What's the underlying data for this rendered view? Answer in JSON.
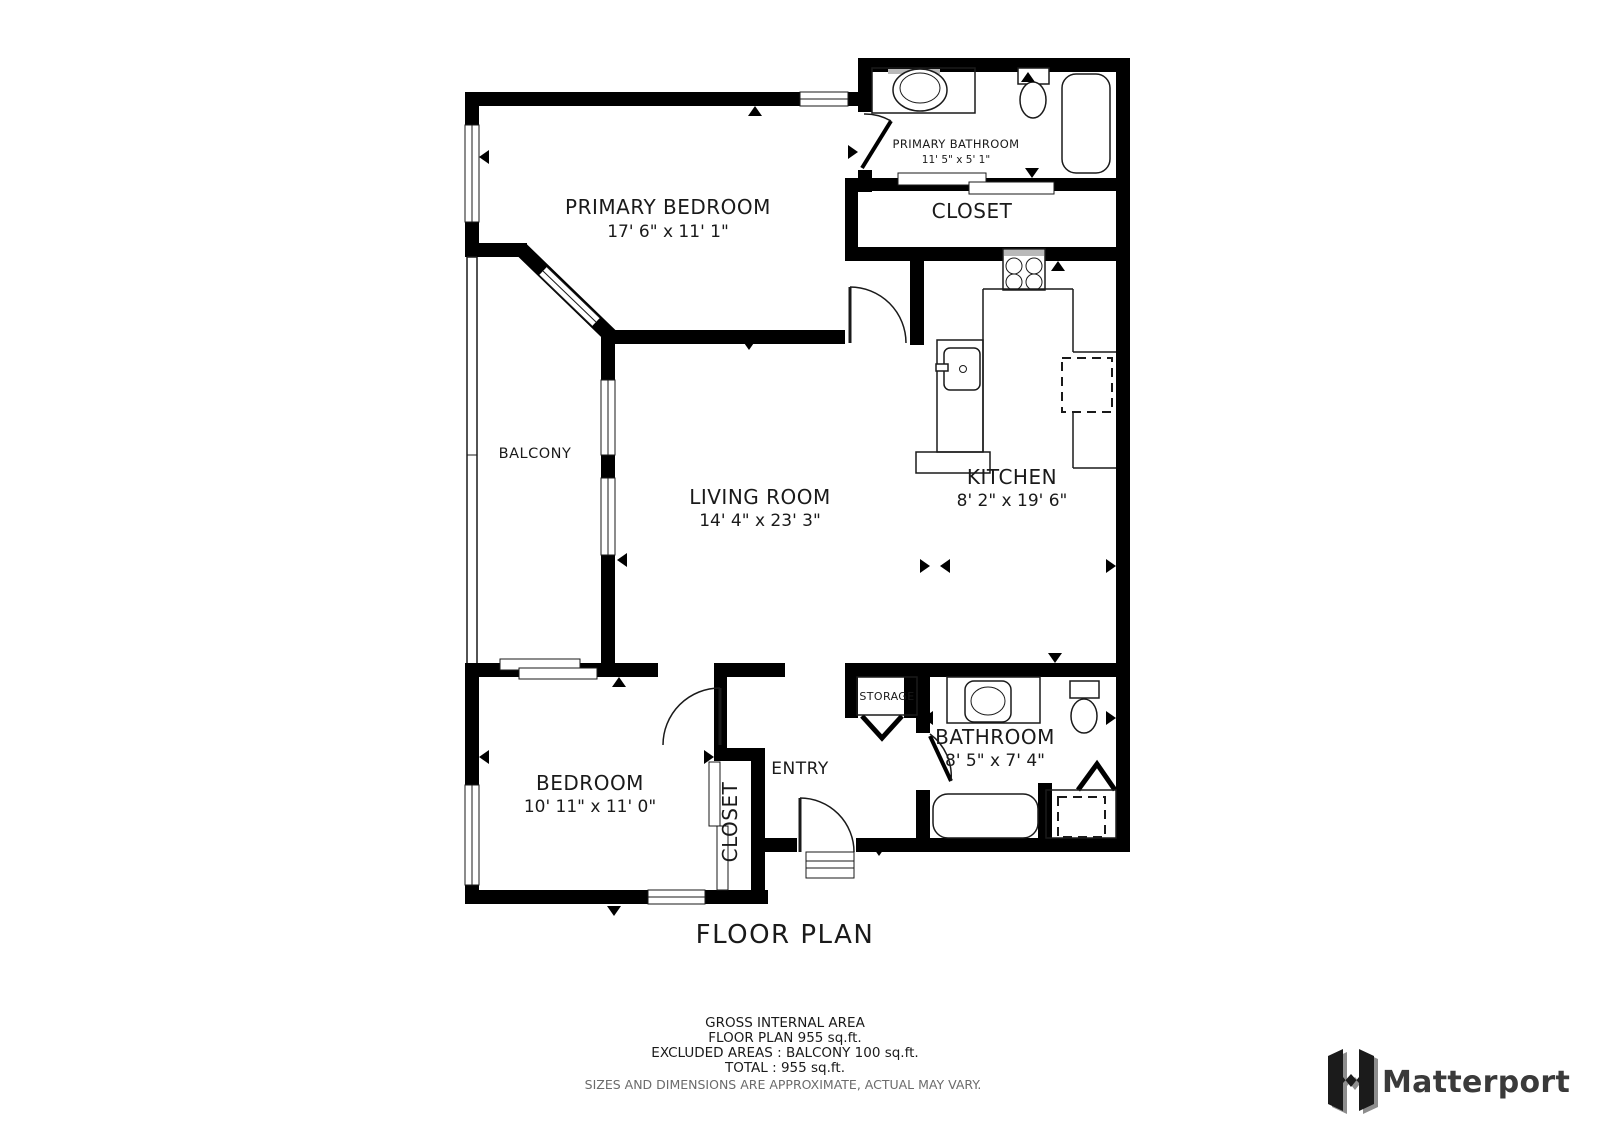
{
  "title": "FLOOR PLAN",
  "rooms": {
    "primary_bedroom": {
      "name": "PRIMARY BEDROOM",
      "dims": "17' 6\" x 11' 1\""
    },
    "primary_bathroom": {
      "name": "PRIMARY BATHROOM",
      "dims": "11' 5\" x 5' 1\""
    },
    "closet_upper": {
      "name": "CLOSET"
    },
    "kitchen": {
      "name": "KITCHEN",
      "dims": "8' 2\" x 19' 6\""
    },
    "living_room": {
      "name": "LIVING ROOM",
      "dims": "14' 4\" x 23' 3\""
    },
    "balcony": {
      "name": "BALCONY"
    },
    "bedroom": {
      "name": "BEDROOM",
      "dims": "10' 11\" x 11' 0\""
    },
    "closet_lower": {
      "name": "CLOSET"
    },
    "entry": {
      "name": "ENTRY"
    },
    "storage": {
      "name": "STORAGE"
    },
    "bathroom": {
      "name": "BATHROOM",
      "dims": "8' 5\" x 7' 4\""
    }
  },
  "footer": {
    "line1": "GROSS INTERNAL AREA",
    "line2": "FLOOR PLAN 955 sq.ft.",
    "line3": "EXCLUDED AREAS :  BALCONY 100 sq.ft.",
    "line4": "TOTAL :  955 sq.ft.",
    "disclaimer": "SIZES AND DIMENSIONS ARE APPROXIMATE, ACTUAL MAY VARY."
  },
  "branding": {
    "logo_text": "Matterport"
  },
  "colors": {
    "wall": "#000000",
    "text": "#1a1a1a",
    "disclaimer": "#6b6b6b",
    "logo": "#3a3a3a"
  }
}
